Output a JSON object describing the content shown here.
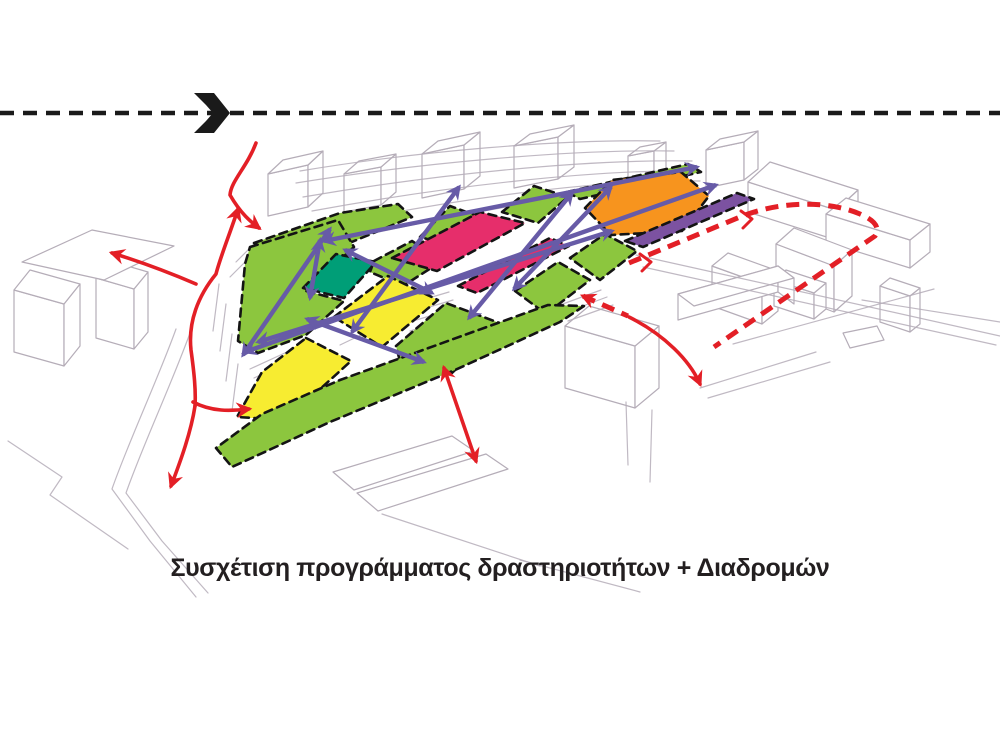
{
  "caption": {
    "text": "Συσχέτιση προγράμματος δραστηριοτήτων + Διαδρομών"
  },
  "palette": {
    "green": "#8CC63E",
    "teal": "#009E77",
    "yellow": "#F7EC31",
    "pink": "#E62E6B",
    "orange": "#F7941E",
    "violet": "#7C52A1",
    "route": "#675BA7",
    "red": "#E31F26",
    "sketch": "#B5ADB8",
    "outline": "#141414",
    "flow_black": "#1a1a1a"
  },
  "flow_line": {
    "y": 113,
    "width": 4.5,
    "dash": "14 9",
    "chevron_path": "M194,93 L214,93 L230,113 L214,133 L194,133 L206,121 L213,113 L206,105 Z"
  },
  "zones": [
    {
      "name": "top-band-west",
      "color": "green",
      "points": "254,243 340,213 398,204 412,217 330,251 288,265"
    },
    {
      "name": "top-green-2",
      "color": "green",
      "points": "420,237 450,206 480,217 452,246"
    },
    {
      "name": "top-green-3",
      "color": "green",
      "points": "502,212 534,186 568,197 538,223"
    },
    {
      "name": "top-strip-ne",
      "color": "green",
      "points": "567,192 688,164 701,172 580,199"
    },
    {
      "name": "green-west",
      "color": "green",
      "points": "250,247 338,220 354,247 306,291 344,301 306,335 258,353 238,341 245,264"
    },
    {
      "name": "teal-zone",
      "color": "teal",
      "points": "303,288 336,254 376,262 344,298"
    },
    {
      "name": "green-mid",
      "color": "green",
      "points": "374,261 412,241 442,261 403,286 370,272"
    },
    {
      "name": "big-pink",
      "color": "pink",
      "points": "392,258 480,212 525,223 437,271"
    },
    {
      "name": "pink-strip",
      "color": "pink",
      "points": "458,286 550,238 569,246 477,293"
    },
    {
      "name": "orange-zone",
      "color": "orange",
      "points": "585,208 612,180 681,172 709,196 682,231 611,235"
    },
    {
      "name": "violet-strip",
      "color": "violet",
      "points": "625,241 737,193 754,199 643,247"
    },
    {
      "name": "green-r1",
      "color": "green",
      "points": "570,258 605,234 637,251 600,280"
    },
    {
      "name": "green-r2",
      "color": "green",
      "points": "515,291 558,262 590,280 546,314"
    },
    {
      "name": "yellow-upper",
      "color": "yellow",
      "points": "334,317 388,276 438,300 382,347"
    },
    {
      "name": "green-c1",
      "color": "green",
      "points": "396,346 446,303 502,324 452,373 402,369"
    },
    {
      "name": "yellow-lower",
      "color": "yellow",
      "points": "306,338 351,361 286,420 237,417 262,372"
    },
    {
      "name": "green-bottom-band",
      "color": "green",
      "points": "584,306 560,322 455,370 330,422 232,467 216,448 262,414 340,380 470,333 548,305"
    }
  ],
  "routes": {
    "width": 4.4,
    "arrows": [
      {
        "name": "route-top-long",
        "x1": 324,
        "y1": 241,
        "x2": 697,
        "y2": 167
      },
      {
        "name": "route-main-long",
        "x1": 245,
        "y1": 352,
        "x2": 716,
        "y2": 185
      },
      {
        "name": "route-mid-long",
        "x1": 258,
        "y1": 342,
        "x2": 612,
        "y2": 231
      },
      {
        "name": "route-cross-1",
        "x1": 330,
        "y1": 229,
        "x2": 243,
        "y2": 355
      },
      {
        "name": "route-cross-2",
        "x1": 459,
        "y1": 187,
        "x2": 352,
        "y2": 332
      },
      {
        "name": "route-cross-3",
        "x1": 572,
        "y1": 193,
        "x2": 469,
        "y2": 318
      },
      {
        "name": "route-cross-4",
        "x1": 611,
        "y1": 187,
        "x2": 514,
        "y2": 289
      },
      {
        "name": "route-edge-short",
        "x1": 307,
        "y1": 319,
        "x2": 424,
        "y2": 362
      },
      {
        "name": "route-teal-short",
        "x1": 320,
        "y1": 240,
        "x2": 310,
        "y2": 298
      },
      {
        "name": "route-diag-short",
        "x1": 345,
        "y1": 250,
        "x2": 432,
        "y2": 293
      }
    ]
  },
  "red_flows": {
    "solid_width": 3.6,
    "dash_width": 5,
    "dash_pattern": "13 8",
    "solid": [
      {
        "name": "flow-entry-north",
        "d": "M256,143 C247,167 231,181 230,195 C241,214 251,222 259,228",
        "start": false,
        "end": true
      },
      {
        "name": "flow-trunk-up",
        "d": "M238,209 C229,236 220,258 216,274 C198,296 188,322 191,350 C194,372 196,390 195,406",
        "start": true,
        "end": false
      },
      {
        "name": "flow-branch-down",
        "d": "M195,406 C191,432 181,460 171,486",
        "start": false,
        "end": true
      },
      {
        "name": "flow-branch-right",
        "d": "M193,402 C212,412 230,411 249,409",
        "start": false,
        "end": true
      },
      {
        "name": "flow-branch-west",
        "d": "M196,284 C168,272 138,261 112,253",
        "start": false,
        "end": true
      },
      {
        "name": "flow-east-curve",
        "d": "M629,317 C665,335 690,361 700,384",
        "start": false,
        "end": true
      }
    ],
    "double": [
      {
        "name": "flow-south-double",
        "x1": 444,
        "y1": 368,
        "x2": 476,
        "y2": 461
      }
    ],
    "dashed": [
      {
        "name": "boundary-east-loop",
        "d": "M629,263 L740,217 C782,200 830,201 860,214 C876,221 880,228 875,236 L714,347",
        "start": false,
        "end": false
      },
      {
        "name": "boundary-east-tail",
        "d": "M583,296 L628,316",
        "start": true,
        "end": false
      }
    ],
    "chevrons": [
      {
        "name": "boundary-tick-1",
        "d": "M640,254 L651,262 L642,271"
      },
      {
        "name": "boundary-tick-2",
        "d": "M741,211 L752,219 L743,228"
      }
    ]
  },
  "sketch": {
    "line_width": 1.2,
    "cubes": [
      [
        268,
        216,
        40,
        -9,
        15,
        -14,
        42
      ],
      [
        344,
        212,
        37,
        -7,
        15,
        -13,
        38
      ],
      [
        422,
        198,
        42,
        -9,
        16,
        -13,
        44
      ],
      [
        514,
        188,
        44,
        -9,
        16,
        -12,
        42
      ],
      [
        628,
        196,
        26,
        -5,
        12,
        -9,
        40
      ],
      [
        706,
        188,
        38,
        -8,
        14,
        -11,
        38
      ],
      [
        748,
        212,
        88,
        28,
        22,
        -20,
        30
      ],
      [
        826,
        242,
        84,
        26,
        20,
        -16,
        28
      ],
      [
        776,
        290,
        58,
        22,
        18,
        -16,
        46
      ],
      [
        712,
        306,
        50,
        18,
        16,
        -13,
        40
      ],
      [
        774,
        306,
        40,
        13,
        12,
        -10,
        26
      ],
      [
        880,
        322,
        30,
        10,
        10,
        -8,
        36
      ],
      [
        565,
        388,
        70,
        20,
        24,
        -20,
        62
      ],
      [
        678,
        320,
        100,
        -28,
        16,
        12,
        26
      ],
      [
        14,
        352,
        50,
        14,
        16,
        -20,
        62
      ],
      [
        96,
        338,
        38,
        11,
        14,
        -17,
        60
      ]
    ],
    "quads": [
      {
        "name": "sketch-roof-left",
        "points": "22,262 92,230 174,246 104,280"
      },
      {
        "name": "sketch-lot-1",
        "points": "333,472 452,436 474,451 354,490"
      },
      {
        "name": "sketch-lot-2",
        "points": "357,493 486,454 508,469 378,511"
      },
      {
        "name": "sketch-lot-3",
        "points": "843,333 877,326 884,340 850,348"
      }
    ],
    "lines": [
      "M300,171 C420,151 560,139 660,141",
      "M296,183 C420,163 572,149 674,151",
      "M303,197 C432,175 582,159 692,161",
      "M312,211 C442,187 592,169 700,171",
      "M332,225 C452,199 600,179 700,181",
      "M356,237 C472,211 562,197 602,193",
      "M636,255 L1000,336",
      "M643,267 L996,345",
      "M862,300 L1000,322",
      "M700,388 L816,352",
      "M708,398 L830,362",
      "M733,344 L934,289",
      "M398,307 L449,292",
      "M402,315 L453,300",
      "M406,323 L457,308",
      "M410,331 L461,316",
      "M560,305 L601,290",
      "M564,313 L607,297",
      "M568,321 L613,305",
      "M250,369 L287,352",
      "M254,378 L293,360",
      "M258,387 L299,368",
      "M262,396 L305,377",
      "M176,329 C158,379 128,443 112,489 L150,541 L196,597",
      "M190,333 C172,383 142,447 126,493 L162,541 L208,593",
      "M8,441 L62,477 L50,495 L128,549",
      "M219,284 L213,331",
      "M226,304 L220,351",
      "M232,334 L226,381",
      "M238,364 L232,411",
      "M236,262 L253,245",
      "M230,277 L248,259",
      "M626,402 L628,465",
      "M652,410 L650,482",
      "M382,514 L540,566",
      "M520,560 L640,592",
      "M370,300 L395,288",
      "M470,250 L497,238",
      "M340,345 L365,333"
    ]
  }
}
